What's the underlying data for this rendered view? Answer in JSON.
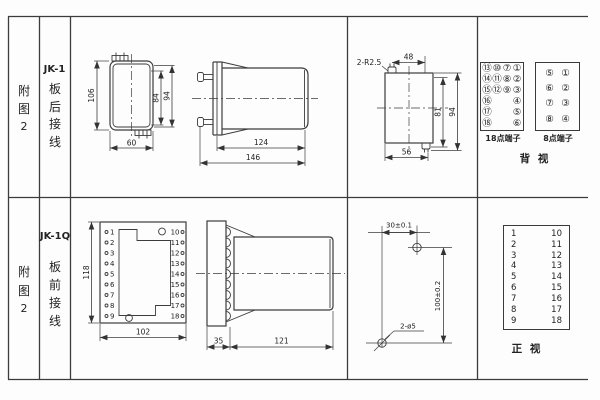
{
  "headers": {
    "row1": {
      "fig": [
        "附",
        "图",
        "2"
      ],
      "model": "JK-1",
      "wiring": [
        "板",
        "后",
        "接",
        "线"
      ]
    },
    "row2": {
      "fig": [
        "附",
        "图",
        "2"
      ],
      "model": "JK-1Q",
      "wiring": [
        "板",
        "前",
        "接",
        "线"
      ]
    }
  },
  "jk1": {
    "front": {
      "height": "106",
      "width": "60",
      "inner_height": "84",
      "outer_height": "94"
    },
    "side": {
      "body_length": "124",
      "total_length": "146"
    },
    "cutout": {
      "radius_note": "2-R2.5",
      "top_width": "48",
      "inner_height": "81",
      "outer_height": "94",
      "bottom_width": "56"
    },
    "terminals18": {
      "label": "18点端子",
      "rows": [
        [
          "⑬",
          "⑩",
          "⑦",
          "①"
        ],
        [
          "⑭",
          "⑪",
          "⑧",
          "②"
        ],
        [
          "⑮",
          "⑫",
          "⑨",
          "③"
        ],
        [
          "⑯",
          "",
          "",
          "④"
        ],
        [
          "⑰",
          "",
          "",
          "⑤"
        ],
        [
          "⑱",
          "",
          "",
          "⑥"
        ]
      ]
    },
    "terminals8": {
      "label": "8点端子",
      "rows": [
        [
          "⑤",
          "①"
        ],
        [
          "⑥",
          "②"
        ],
        [
          "⑦",
          "③"
        ],
        [
          "⑧",
          "④"
        ]
      ]
    },
    "view_label": "背  视"
  },
  "jk1q": {
    "plate": {
      "height": "118",
      "width": "102",
      "left_pins": [
        "1",
        "2",
        "3",
        "4",
        "5",
        "6",
        "7",
        "8",
        "9"
      ],
      "right_pins": [
        "10",
        "11",
        "12",
        "13",
        "14",
        "15",
        "16",
        "17",
        "18"
      ]
    },
    "side": {
      "plate_depth": "35",
      "body_length": "121"
    },
    "holes": {
      "horizontal": "30±0.1",
      "vertical": "100±0.2",
      "note": "2-ø5"
    },
    "front_table": {
      "left": [
        "1",
        "2",
        "3",
        "4",
        "5",
        "6",
        "7",
        "8",
        "9"
      ],
      "right": [
        "10",
        "11",
        "12",
        "13",
        "14",
        "15",
        "16",
        "17",
        "18"
      ]
    },
    "view_label": "正  视"
  }
}
